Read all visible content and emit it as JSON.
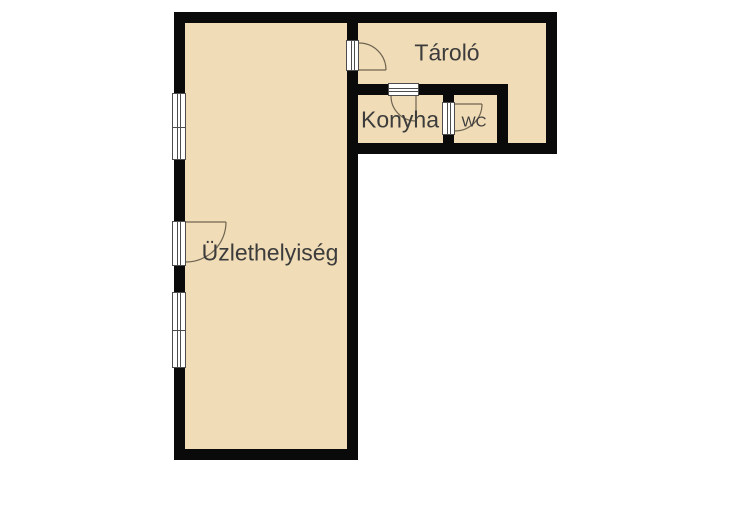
{
  "floorplan": {
    "type": "floor-plan",
    "rooms": {
      "uzlethelyiseg": {
        "label": "Üzlethelyiség"
      },
      "tarolo": {
        "label": "Tároló"
      },
      "konyha": {
        "label": "Konyha"
      },
      "wc": {
        "label": "WC"
      }
    },
    "features": {
      "windows": 2,
      "doors": 4
    },
    "colors": {
      "background": "#ffffff",
      "floor_fill": "#f0dcb6",
      "wall": "#0a0a0a",
      "label_text": "#3c3c3c",
      "door_swing": "#6f6452",
      "opening_frame": "#4d4d4d"
    }
  }
}
